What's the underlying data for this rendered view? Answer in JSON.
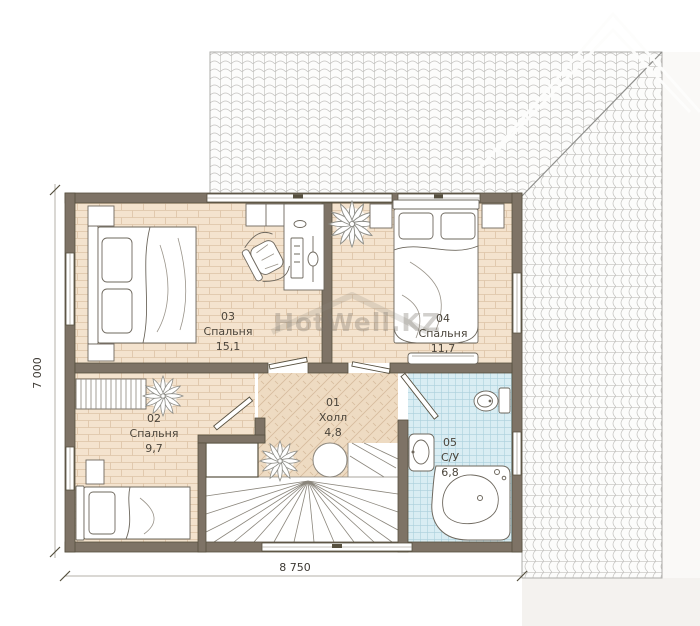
{
  "title": "Floor plan — second level",
  "watermark": {
    "text": "HotWell.KZ"
  },
  "dimensions": {
    "horizontal": "8 750",
    "vertical": "7 000"
  },
  "rooms": [
    {
      "number": "03",
      "name": "Спальня",
      "area": "15,1"
    },
    {
      "number": "04",
      "name": "Спальня",
      "area": "11,7"
    },
    {
      "number": "02",
      "name": "Спальня",
      "area": "9,7"
    },
    {
      "number": "01",
      "name": "Холл",
      "area": "4,8"
    },
    {
      "number": "05",
      "name": "С/У",
      "area": "6,8"
    }
  ],
  "colors": {
    "wall": "#7e7366",
    "wall_outline": "#57503f",
    "floor_wood": "#f4e3ce",
    "floor_wood_line": "#ddc3a6",
    "floor_herringbone": "#eedbc2",
    "floor_herringbone_line": "#d6bb9d",
    "bathroom_tile": "#d9edf3",
    "bathroom_tile_line": "#abd0dc",
    "roof_tile_line": "#c2c1be"
  }
}
